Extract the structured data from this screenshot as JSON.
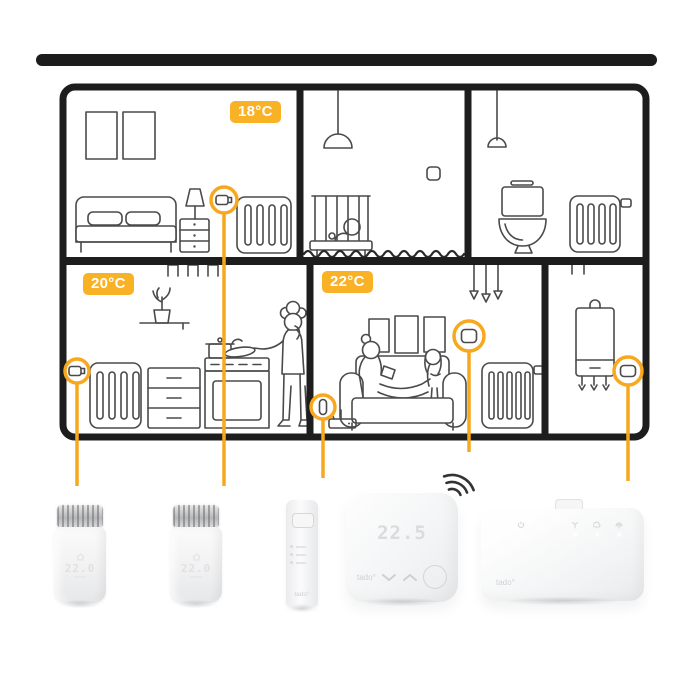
{
  "colors": {
    "accent": "#F8A81E",
    "badge": "#F9B125",
    "roof_bar": "#1C1C1C",
    "line_art": "#4A4A4A"
  },
  "rooms": {
    "bedroom": {
      "temperature": "18°C"
    },
    "kitchen": {
      "temperature": "20°C"
    },
    "living_room": {
      "temperature": "22°C"
    }
  },
  "devices": {
    "radiator_thermostat_1": {
      "display_value": "22.0"
    },
    "radiator_thermostat_2": {
      "display_value": "22.0"
    },
    "wireless_temperature_sensor": {
      "brand": "tado°"
    },
    "smart_thermostat": {
      "display_value": "22.5",
      "brand": "tado°"
    },
    "wireless_receiver": {
      "brand": "tado°"
    }
  }
}
